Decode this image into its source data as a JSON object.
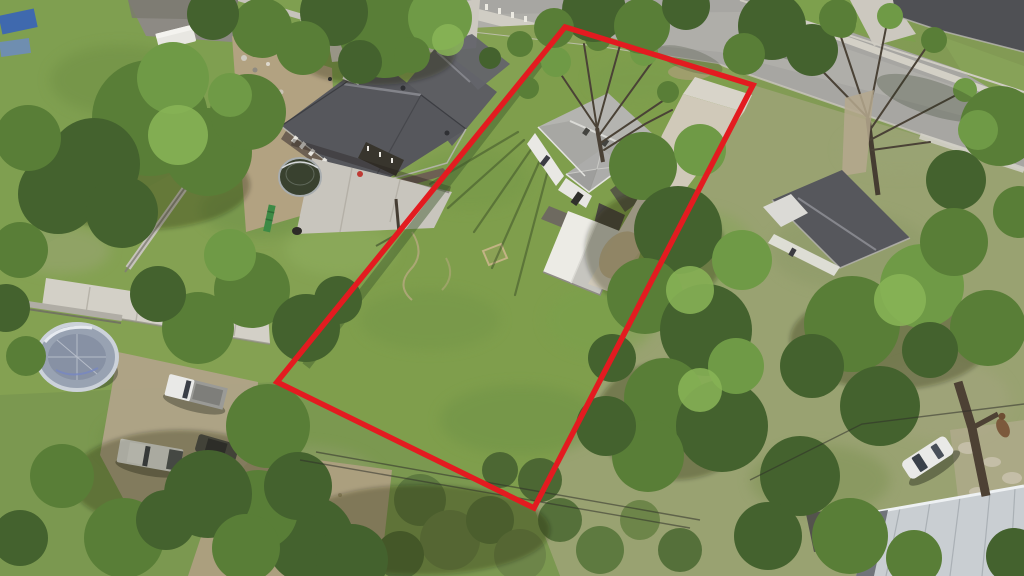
{
  "scene": {
    "type": "aerial-drone-photo",
    "description": "Aerial view of a residential neighborhood; vacant lot with small white house, shed and large lawn outlined in red",
    "canvas_width": 1024,
    "canvas_height": 576
  },
  "boundary": {
    "name": "property-boundary-overlay",
    "points": "565,27 753,85 534,508 277,382",
    "color": "#e31b20",
    "stroke_width": "5.5"
  },
  "palette": {
    "lawn_green": "#7f9e4c",
    "bright_grass": "#84a152",
    "dry_grass": "#99a271",
    "dirt_tan": "#b2a281",
    "concrete": "#d3d0c7",
    "asphalt": "#a7a6a2",
    "roof_dark_gray": "#56575c",
    "roof_light_gray": "#b4b4b0",
    "shed_white": "#ecebe5",
    "metal_roof": "#c9ced2",
    "vehicle_white": "#e9e9e7",
    "tree_dark": "#44622e",
    "tree_mid": "#597e37",
    "tree_light": "#6f9a46",
    "boundary_red": "#e31b20"
  },
  "objects": {
    "boundary": "property-boundary-overlay",
    "subject_house": "small-white-house-gray-roof",
    "shed": "storage-shed",
    "lawn": "subject-lot-lawn",
    "driveway": "concrete-driveway",
    "street": "street-top-right",
    "neighbor_left": "new-build-house-dark-roof",
    "neighbor_right": "house-dark-roof-right",
    "metal_building": "metal-roof-building",
    "vehicles": [
      "white-car",
      "pickup-truck",
      "pickup-truck",
      "dark-car"
    ],
    "recreation": [
      "enclosed-trampoline",
      "round-trampoline"
    ],
    "utilities": [
      "power-lines",
      "utility-pole"
    ]
  }
}
